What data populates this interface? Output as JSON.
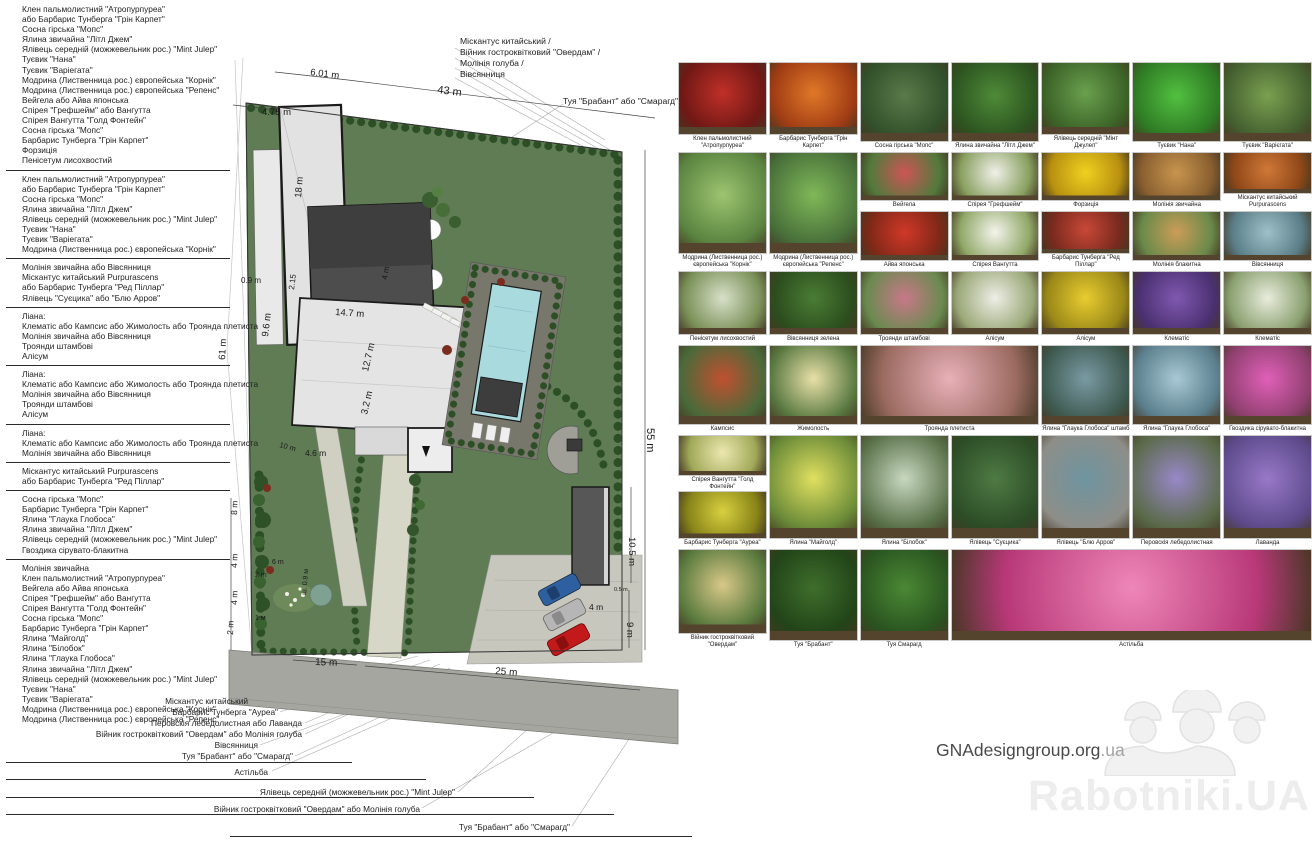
{
  "left_plant_groups": [
    {
      "lines": [
        "Клен пальмолистний \"Атропурпуреа\"",
        "або Барбарис Тунберга \"Грін Карпет\"",
        "Сосна гірська \"Мопс\"",
        "Ялина звичайна \"Літл Джем\"",
        "Ялівець середній (можжевельник рос.) \"Mint Julep\"",
        "Туєвик \"Нана\"",
        "Туєвик \"Варіегата\"",
        "Модрина (Лиственница рос.) європейська \"Корнік\"",
        "Модрина (Лиственница рос.) європейська \"Репенс\"",
        "Вейгела або Айва японська",
        "Спірея \"Грефшейм\" або Вангутта",
        "Спірея Вангутта \"Голд Фонтейн\"",
        "Сосна гірська \"Мопс\"",
        "Барбарис Тунберга \"Грін Карпет\"",
        "Форзиція",
        "Пенісетум лисохвостий"
      ]
    },
    {
      "lines": [
        "Клен пальмолистний \"Атропурпуреа\"",
        "або Барбарис Тунберга \"Грін Карпет\"",
        "Сосна гірська \"Мопс\"",
        "Ялина звичайна \"Літл Джем\"",
        "Ялівець середній (можжевельник рос.) \"Mint Julep\"",
        "Туєвик \"Нана\"",
        "Туєвик \"Варіегата\"",
        "Модрина (Лиственница рос.) європейська \"Корнік\""
      ]
    },
    {
      "lines": [
        "Молінія звичайна або Вівсянниця",
        "Міскантус китайський Purpurascens",
        "або Барбарис Тунберга \"Ред Піллар\"",
        "Ялівець \"Суєцика\" або \"Блю Арров\""
      ]
    },
    {
      "lines": [
        "Ліана:",
        "Клематіс або Кампсис або Жимолость або Троянда плетиста",
        "Молінія звичайна або Вівсянниця",
        "Троянди штамбові",
        "Алісум"
      ]
    },
    {
      "lines": [
        "Ліана:",
        "Клематіс або Кампсис або Жимолость або Троянда плетиста",
        "Молінія звичайна або Вівсянниця",
        "Троянди штамбові",
        "Алісум"
      ]
    },
    {
      "lines": [
        "Ліана:",
        "Клематіс або Кампсис або Жимолость або Троянда плетиста",
        "Молінія звичайна або Вівсянниця"
      ]
    },
    {
      "lines": [
        "Міскантус китайський Purpurascens",
        "або Барбарис Тунберга \"Ред Піллар\""
      ]
    },
    {
      "lines": [
        "Сосна гірська \"Мопс\"",
        "Барбарис Тунберга \"Грін Карпет\"",
        "Ялина \"Глаука Глобоса\"",
        "Ялина звичайна \"Літл Джем\"",
        "Ялівець середній (можжевельник рос.) \"Mint Julep\"",
        "Гвоздика сірувато-блакитна"
      ]
    },
    {
      "lines": [
        "Молінія звичайна",
        "Клен пальмолистний \"Атропурпуреа\"",
        "Вейгела або Айва японська",
        "Спірея \"Грефшейм\" або Вангутта",
        "Спірея Вангутта \"Голд Фонтейн\"",
        "Сосна гірська \"Мопс\"",
        "Барбарис Тунберга \"Грін Карпет\"",
        "Ялина \"Майголд\"",
        "Ялина \"Білобок\"",
        "Ялина \"Глаука Глобоса\"",
        "Ялина звичайна \"Літл Джем\"",
        "Ялівець середній (можжевельник рос.) \"Mint Julep\"",
        "Туєвик \"Нана\"",
        "Туєвик \"Варіегата\"",
        "Модрина (Лиственница рос.) європейська \"Корнік\"",
        "Модрина (Лиственница рос.) європейська \"Репенс\""
      ]
    }
  ],
  "top_labels": {
    "lines": [
      "Міскантус китайський /",
      "Війник гостроквітковий \"Овердам\" /",
      "Молінія голуба /",
      "Вівсянниця"
    ],
    "thuja": "Туя \"Брабант\" або \"Смарагд\""
  },
  "bottom_labels": [
    "Міскантус китайський",
    "Барбарис Тунберга \"Ауреа\"",
    "Перовскія лебедолистная або Лаванда",
    "Війник гостроквітковий \"Овердам\" або Молінія голуба",
    "Вівсянниця",
    "Туя \"Брабант\" або \"Смарагд\"",
    "Астільба",
    "Ялівець середній (можжевельник рос.) \"Mint Julep\"",
    "Війник гостроквітковий \"Овердам\" або Молінія голуба",
    "Туя \"Брабант\" або \"Смарагд\""
  ],
  "plan": {
    "dimensions": [
      "6.01 m",
      "43 m",
      "4.75 m",
      "18 m",
      "0.9 m",
      "2.15",
      "14.7 m",
      "9.6 m",
      "12.7 m",
      "3.2 m",
      "4 m",
      "4.6 m",
      "61 m",
      "8 m",
      "4 m",
      "4 m",
      "2 m",
      "2 m",
      "6 m",
      "1 м",
      "10 m",
      "ш. 0.9 м",
      "15 m",
      "25 m",
      "55 m",
      "10.5 m",
      "9 m",
      "4 m",
      "0.5 m"
    ]
  },
  "catalog": {
    "rows": [
      {
        "cells": [
          {
            "label": "Клен пальмолистний \"Атропурпуреа\"",
            "c1": "#c03028",
            "c2": "#701815"
          },
          {
            "label": "Барбарис Тунберга \"Грін Карпет\"",
            "c1": "#e07828",
            "c2": "#a03c14"
          },
          {
            "label": "Сосна гірська \"Мопс\"",
            "c1": "#5a7a4a",
            "c2": "#32502a"
          },
          {
            "label": "Ялина звичайна \"Літл Джем\"",
            "c1": "#4e8a38",
            "c2": "#2c5420"
          },
          {
            "label": "Ялівець середній \"Мінт Джулеп\"",
            "c1": "#6aa04e",
            "c2": "#3c6428"
          },
          {
            "label": "Туєвик \"Нана\"",
            "c1": "#52c040",
            "c2": "#2e7a24"
          },
          {
            "label": "Туєвик \"Варієгата\"",
            "c1": "#7aa050",
            "c2": "#446030"
          }
        ]
      },
      {
        "cells": [
          {
            "label": "Модрина (Лиственница рос.) європейська \"Корнік\"",
            "c1": "#9cc470",
            "c2": "#5a8440",
            "row_span": 2
          },
          {
            "label": "Модрина (Лиственница рос.) європейська \"Репенс\"",
            "c1": "#80b858",
            "c2": "#48703a",
            "row_span": 2
          },
          {
            "label": "Вейгела",
            "c1": "#cc5555",
            "c2": "#527a3c"
          },
          {
            "label": "Спірея \"Грефшейм\"",
            "c1": "#f0f0e8",
            "c2": "#88a060"
          },
          {
            "label": "Форзиція",
            "c1": "#f0d020",
            "c2": "#b89010"
          },
          {
            "label": "Молінія звичайна",
            "c1": "#c8954e",
            "c2": "#8a6030"
          },
          {
            "label": "Міскантус китайський Purpurascens",
            "c1": "#d07838",
            "c2": "#904818"
          }
        ]
      },
      {
        "cells": [
          {
            "label": "Айва японська",
            "c1": "#d03828",
            "c2": "#802818",
            "col": 3
          },
          {
            "label": "Спірея Вангутта",
            "c1": "#f4f4ec",
            "c2": "#90a868"
          },
          {
            "label": "Барбарис Тунберга \"Ред Піллар\"",
            "c1": "#c84838",
            "c2": "#7a2a1e"
          },
          {
            "label": "Молінія блакитна",
            "c1": "#cc9c58",
            "c2": "#6a8a4a"
          },
          {
            "label": "Вівсянниця",
            "c1": "#9ec0c8",
            "c2": "#5a7e88"
          }
        ]
      },
      {
        "cells": [
          {
            "label": "Пенісетум лисохвостий",
            "c1": "#d8e0c8",
            "c2": "#7a9058"
          },
          {
            "label": "Вівсянниця зелена",
            "c1": "#4a7c34",
            "c2": "#2c4e1e"
          },
          {
            "label": "Троянди штамбові",
            "c1": "#c87888",
            "c2": "#6a8a50"
          },
          {
            "label": "Алісум",
            "c1": "#eeeee6",
            "c2": "#9aa878"
          },
          {
            "label": "Алісум",
            "c1": "#e8cc30",
            "c2": "#9a8818"
          },
          {
            "label": "Клематіс",
            "c1": "#8058b0",
            "c2": "#4a3070"
          },
          {
            "label": "Клематіс",
            "c1": "#e8ecdc",
            "c2": "#8aa070"
          }
        ]
      },
      {
        "cells": [
          {
            "label": "Кампсис",
            "c1": "#c05030",
            "c2": "#4a6a3a"
          },
          {
            "label": "Жимолость",
            "c1": "#e8e0a8",
            "c2": "#5a7a42"
          },
          {
            "label": "Троянда плетиста",
            "c1": "#e8b0b8",
            "c2": "#9a6a60",
            "col_span": 2
          },
          {
            "label": "Ялина \"Глаука Глобоса\" штамб",
            "c1": "#7a9aa4",
            "c2": "#3e5a50"
          },
          {
            "label": "Ялина \"Глаука Глобоса\"",
            "c1": "#a8c8d4",
            "c2": "#5a7e8c"
          },
          {
            "label": "Гвоздика сірувато-блакитна",
            "c1": "#e060b8",
            "c2": "#904070"
          }
        ]
      },
      {
        "cells": [
          {
            "stack": [
              {
                "label": "Спірея Вангутта \"Голд Фонтейн\"",
                "c1": "#ece8b0",
                "c2": "#a0a858"
              },
              {
                "label": "Барбарис Тунберга \"Ауреа\"",
                "c1": "#d8d040",
                "c2": "#888418"
              }
            ]
          },
          {
            "label": "Ялина \"Майголд\"",
            "c1": "#e0e060",
            "c2": "#6a8a38"
          },
          {
            "label": "Ялина \"Білобок\"",
            "c1": "#c8d8c0",
            "c2": "#587048"
          },
          {
            "label": "Ялівець \"Суєцика\"",
            "c1": "#4e7a44",
            "c2": "#2c4c26"
          },
          {
            "label": "Ялівець \"Блю Арров\"",
            "c1": "#6e94a0",
            "c2": "#8e8e88"
          },
          {
            "label": "Перовскія лебедолистная",
            "c1": "#9888c8",
            "c2": "#5a6a48"
          },
          {
            "label": "Лаванда",
            "c1": "#9878c8",
            "c2": "#5c4a8a"
          }
        ]
      },
      {
        "cells": [
          {
            "label": "Війник гостроквітковий \"Овердам\"",
            "c1": "#d8c888",
            "c2": "#5a7a3e"
          },
          {
            "label": "Туя \"Брабант\"",
            "c1": "#3e6e2c",
            "c2": "#224418"
          },
          {
            "label": "Туя Смарагд",
            "c1": "#4a8834",
            "c2": "#2a5420"
          },
          {
            "label": "Астільба",
            "c1": "#ee86b8",
            "c2": "#b83878",
            "col_span": 4
          }
        ]
      }
    ]
  },
  "watermark": {
    "site": "GNAdesigngroup.org",
    "site_suffix": ".ua",
    "brand": "Rabotniki.UA"
  },
  "colors": {
    "lawn": "#5f7c54",
    "hedge": "#2c4f26",
    "pool": "#a9dade",
    "road": "#a6a6a1",
    "house": "#4d4d4d"
  }
}
